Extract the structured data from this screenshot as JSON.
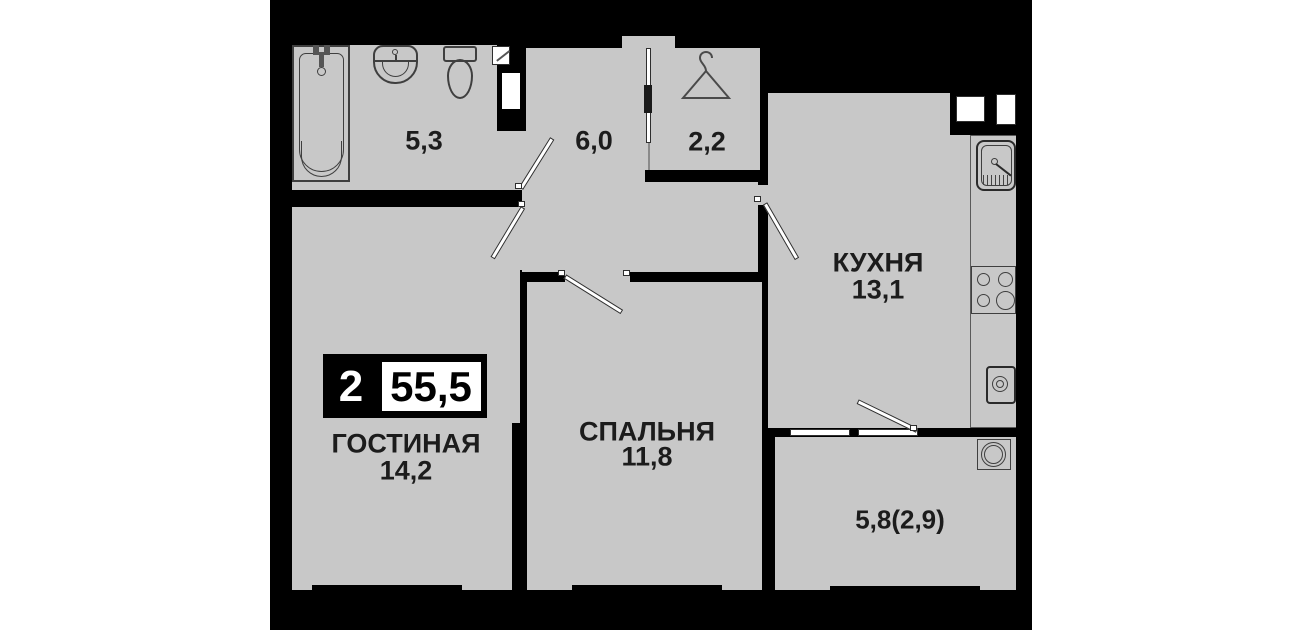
{
  "floorplan": {
    "badge": {
      "rooms_count": "2",
      "total_area": "55,5"
    },
    "rooms": [
      {
        "id": "bathroom",
        "name": "",
        "area": "5,3"
      },
      {
        "id": "hallway",
        "name": "",
        "area": "6,0"
      },
      {
        "id": "wardrobe",
        "name": "",
        "area": "2,2"
      },
      {
        "id": "kitchen",
        "name": "КУХНЯ",
        "area": "13,1"
      },
      {
        "id": "living_room",
        "name": "ГОСТИНАЯ",
        "area": "14,2"
      },
      {
        "id": "bedroom",
        "name": "СПАЛЬНЯ",
        "area": "11,8"
      },
      {
        "id": "balcony",
        "name": "",
        "area": "5,8(2,9)"
      }
    ],
    "fixtures": [
      "bathtub-icon",
      "bath-sink-icon",
      "toilet-icon",
      "hanger-icon",
      "kitchen-sink-icon",
      "stove-icon",
      "washing-machine-icon",
      "balcony-table-icon",
      "vent-shaft",
      "entrance-door",
      "window"
    ],
    "colors": {
      "wall": "#000000",
      "floor": "#c8c8c8",
      "background": "#ffffff",
      "text": "#1c1c1c"
    }
  }
}
